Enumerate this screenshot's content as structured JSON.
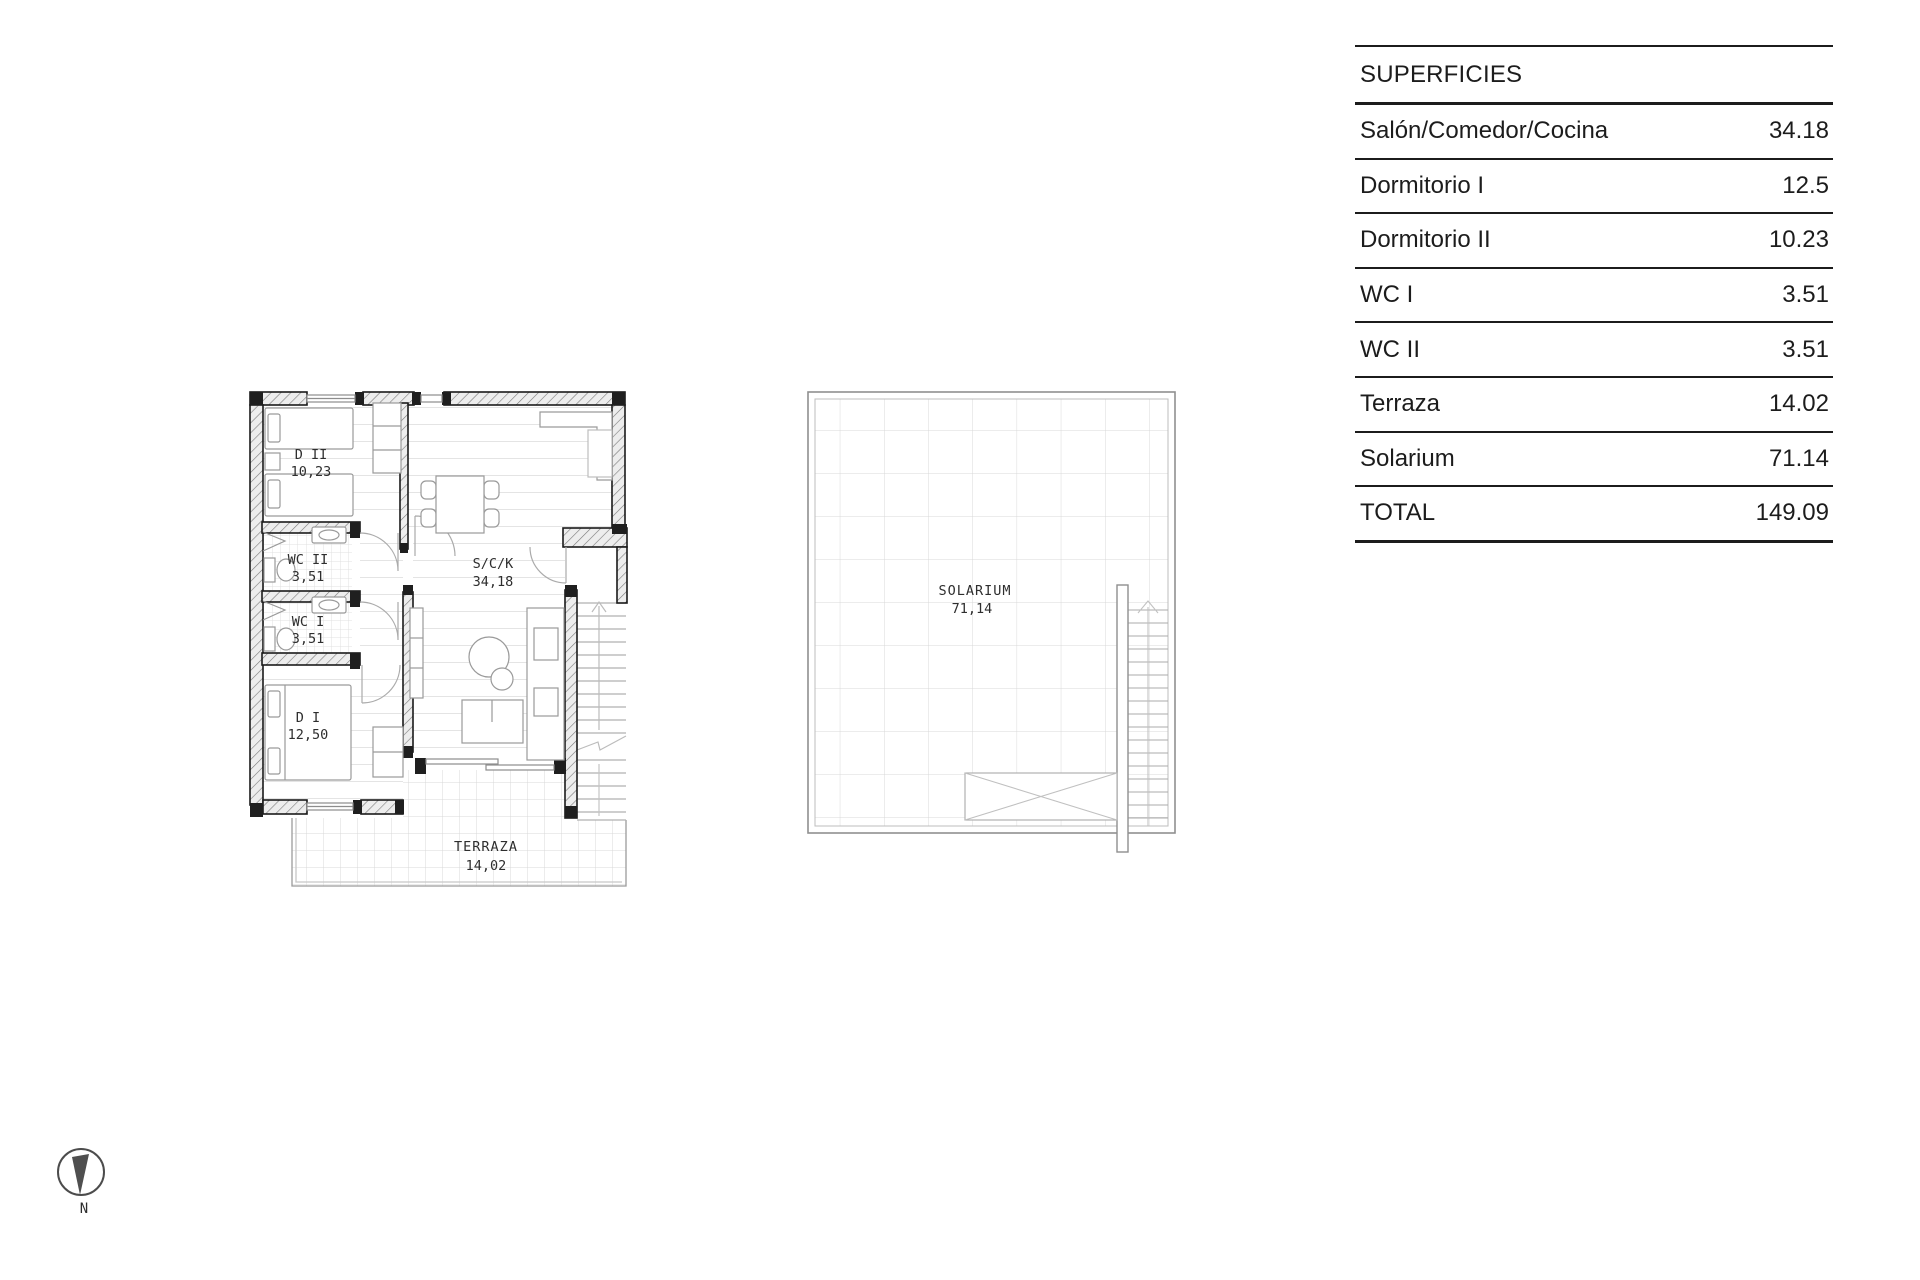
{
  "surfaces_table": {
    "title": "SUPERFICIES",
    "rows": [
      {
        "label": "Salón/Comedor/Cocina",
        "value": "34.18"
      },
      {
        "label": "Dormitorio I",
        "value": "12.5"
      },
      {
        "label": "Dormitorio II",
        "value": "10.23"
      },
      {
        "label": "WC I",
        "value": "3.51"
      },
      {
        "label": "WC II",
        "value": "3.51"
      },
      {
        "label": "Terraza",
        "value": "14.02"
      },
      {
        "label": "Solarium",
        "value": "71.14"
      },
      {
        "label": "TOTAL",
        "value": "149.09"
      }
    ]
  },
  "ground_floor": {
    "rooms": {
      "dormitorio2": {
        "name": "D II",
        "area": "10,23"
      },
      "wc2": {
        "name": "WC II",
        "area": "3,51"
      },
      "wc1": {
        "name": "WC I",
        "area": "3,51"
      },
      "dormitorio1": {
        "name": "D I",
        "area": "12,50"
      },
      "salon_comedor_cocina": {
        "name": "S/C/K",
        "area": "34,18"
      },
      "terraza": {
        "name": "TERRAZA",
        "area": "14,02"
      }
    }
  },
  "roof": {
    "rooms": {
      "solarium": {
        "name": "SOLARIUM",
        "area": "71,14"
      }
    }
  },
  "compass": {
    "north_label": "N"
  },
  "colors": {
    "line": "#1a1a1a",
    "furniture": "#9a9a9a",
    "tile": "#d9d9d9",
    "hatch_fill": "#ededed"
  }
}
